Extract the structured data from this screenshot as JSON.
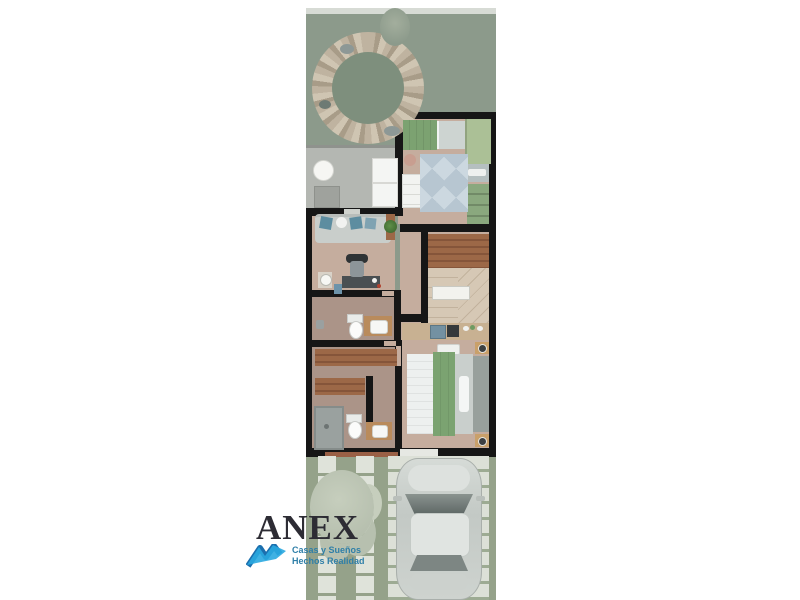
{
  "logo": {
    "name": "ANEX",
    "tagline1": "Casas y Sueños",
    "tagline2": "Hechos Realidad"
  },
  "colors": {
    "page-bg": "#ffffff",
    "garden": "#8c9a8b",
    "garden-dark": "#7e8f7d",
    "stone-a": "#bfb3a0",
    "stone-b": "#a89c88",
    "wall": "#161616",
    "floor": "#c5ad9e",
    "floor-dark": "#ab9488",
    "patio": "#b4b7b2",
    "white-unit": "#f4f5f3",
    "bed-green": "#7ca271",
    "wardrobe-green": "#abc096",
    "drawer-green": "#8aa87e",
    "rug-light": "#ccd8e0",
    "rug-dark": "#b7c6d1",
    "sofa": "#c9cecb",
    "teal": "#5d8da0",
    "wood": "#9c6847",
    "wood-dark": "#85553a",
    "stairs": "#d6c8b5",
    "stairs-dark": "#c2b29d",
    "counter-wood": "#c8b192",
    "duvet": "#7ba371",
    "sheet": "#edf0ef",
    "mattress": "#c9cfcc",
    "headboard": "#98a09c",
    "nightstand": "#c9a06a",
    "shower": "#9aa19f",
    "yard-green": "#95a28a",
    "paver": "#dfe3da",
    "drive-light": "#dce0d7",
    "drive-gap": "#9dab93",
    "tree": "#b7c0af",
    "tree-light": "#c6cebd",
    "car-body": "#cdd2ce",
    "car-line": "#a9afab",
    "car-glass": "#707977",
    "car-roof": "#e0e4e1",
    "terracotta": "#9a6046",
    "logo-text": "#2d2c34",
    "logo-blue": "#2f7fa8",
    "mark-blue": "#2aa9e0",
    "mark-navy": "#1b6fae"
  }
}
